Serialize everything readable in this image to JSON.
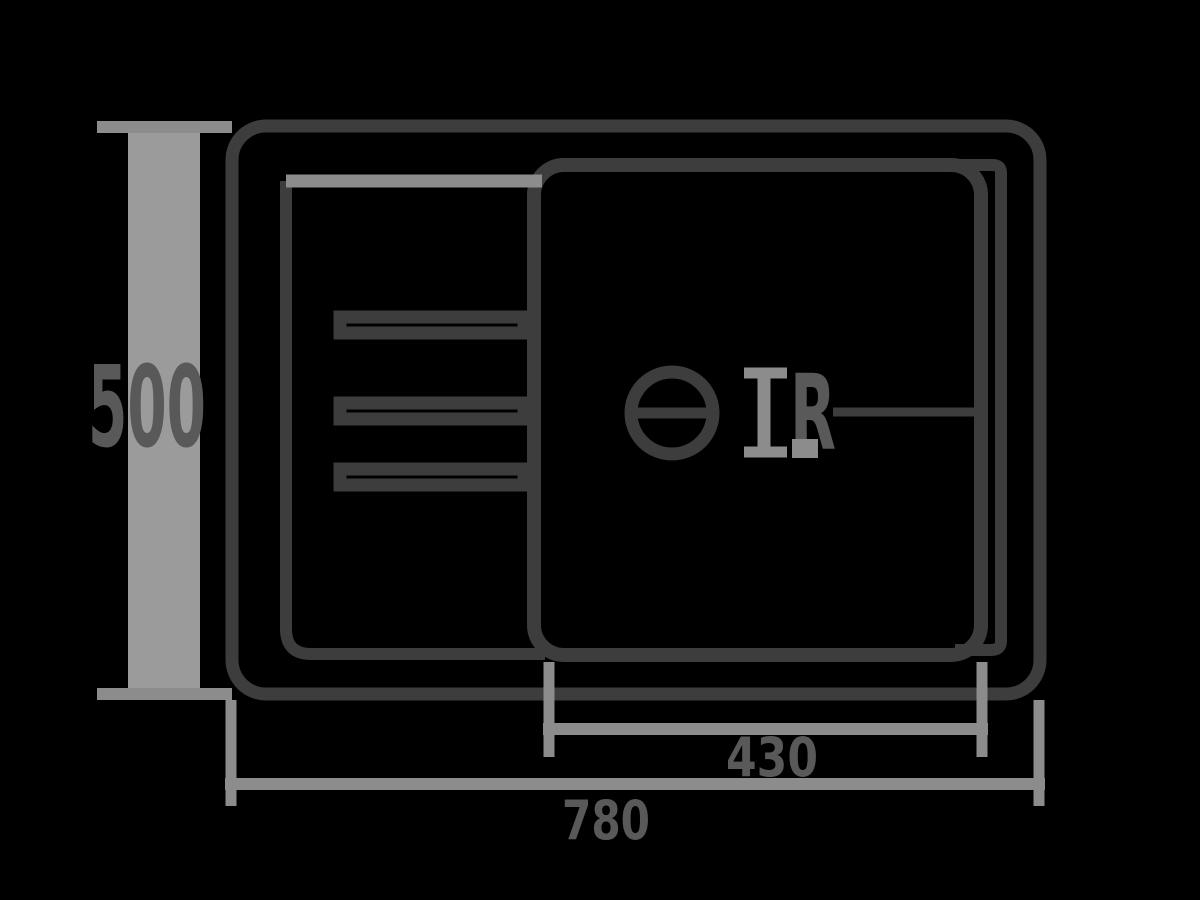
{
  "colors": {
    "background": "#000000",
    "outline": "#3d3d3d",
    "dimension": "#8c8c8c",
    "dimension-bar": "#9b9b9b",
    "label": "#595959"
  },
  "labels": {
    "depth": "500",
    "bowl_width": "430",
    "overall_width": "780",
    "radius": "R"
  }
}
